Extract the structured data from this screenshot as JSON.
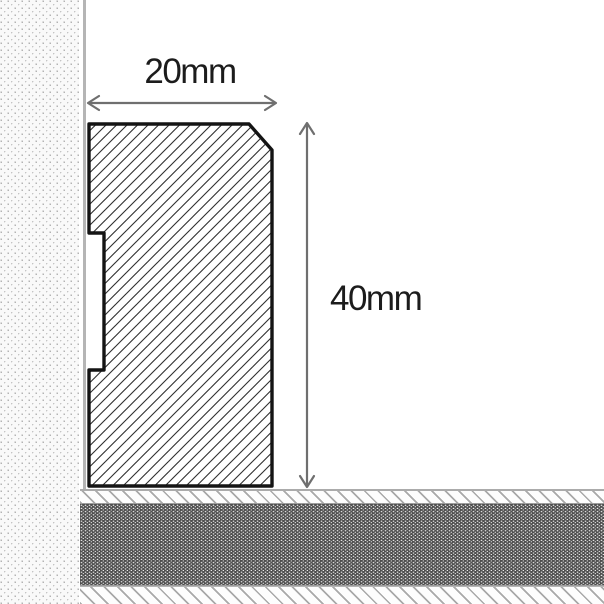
{
  "diagram": {
    "type": "technical-cross-section",
    "subject": "skirting board profile installed against wall and floor",
    "dimensions": {
      "width_label": "20mm",
      "height_label": "40mm"
    },
    "colors": {
      "background": "#ffffff",
      "profile_outline": "#141414",
      "profile_hatch_line": "#2e2e2e",
      "dimension_arrow": "#6f6f6f",
      "label_text": "#1c1c1c",
      "wall_surface_line": "#b5b5b5",
      "floor_core": "#4f4f4f",
      "floor_hatch_line": "#949494",
      "wall_dot": "#9f9f9f"
    }
  }
}
